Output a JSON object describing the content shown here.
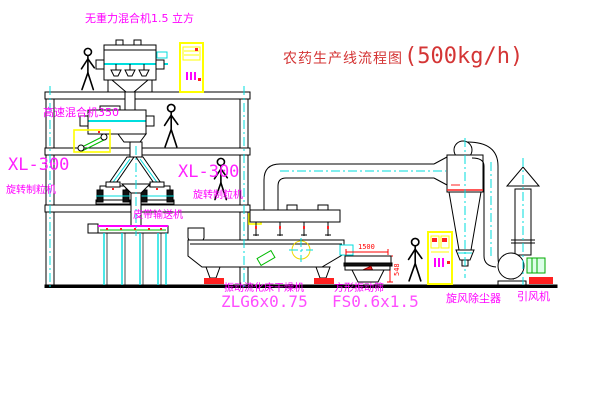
{
  "title": {
    "text": "农药生产线流程图",
    "capacity": "(500kg/h)"
  },
  "labels": {
    "gravity_mixer": "无重力混合机1.5 立方",
    "high_speed_mixer": "高速混合机350",
    "granulator_left_model": "XL-300",
    "granulator_left_name": "旋转制粒机",
    "granulator_center_model": "XL-300",
    "granulator_center_name": "旋转制粒机",
    "belt_conveyor": "皮带输送机",
    "dryer_name": "振动流化床干燥机",
    "dryer_model": "ZLG6x0.75",
    "sieve_name": "方形振动筛",
    "sieve_model": "FS0.6x1.5",
    "cyclone_duster": "旋风除尘器",
    "induced_fan": "引风机",
    "sieve_dim_width": "1500",
    "sieve_dim_height": "548"
  },
  "colors": {
    "background": "#ffffff",
    "line_black": "#000000",
    "label_magenta": "#ff00ff",
    "model_pink": "#ff4dff",
    "title_red": "#d43535",
    "dimension_red": "#ff0000",
    "centerline_cyan": "#00dede",
    "cabinet_yellow": "#ffff00",
    "belt_green": "#00bb00"
  },
  "icons": {
    "person": "walking-worker-outline",
    "control_cabinet": "yellow-electric-cabinet",
    "cyclone": "cyclone-separator-cone",
    "fan": "induced-draft-fan-scroll"
  }
}
